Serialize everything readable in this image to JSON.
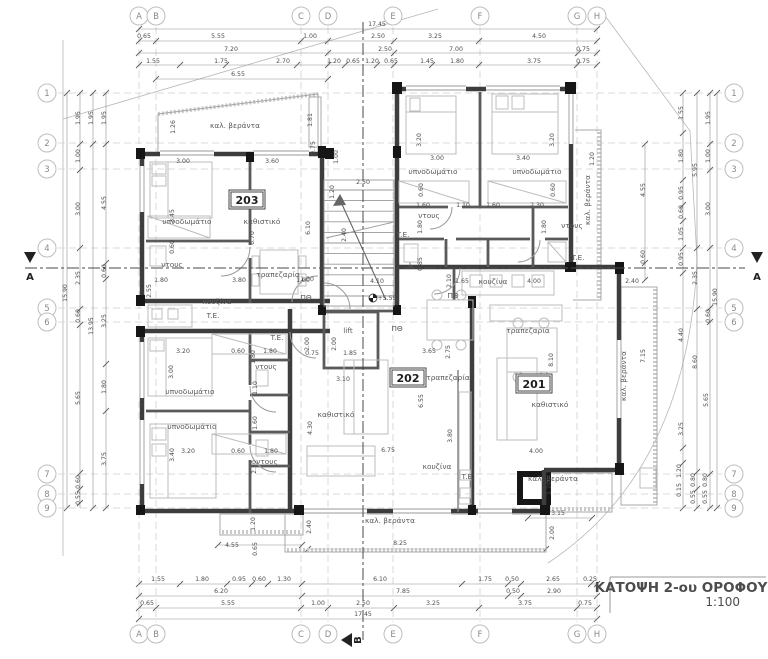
{
  "title": {
    "name": "ΚΑΤΟΨΗ 2-ου ΟΡΟΦΟΥ",
    "scale": "1:100"
  },
  "sections": {
    "a": "A",
    "b": "B"
  },
  "level_marker": "+5.55",
  "units": [
    {
      "n": "203",
      "x": 247,
      "y": 203
    },
    {
      "n": "202",
      "x": 408,
      "y": 381
    },
    {
      "n": "201",
      "x": 534,
      "y": 387
    }
  ],
  "grid": {
    "letters": [
      [
        "A",
        139
      ],
      [
        "B",
        156
      ],
      [
        "C",
        301
      ],
      [
        "D",
        328
      ],
      [
        "E",
        393
      ],
      [
        "F",
        480
      ],
      [
        "G",
        577
      ],
      [
        "H",
        597
      ]
    ],
    "numbers": [
      [
        "1",
        93
      ],
      [
        "2",
        143
      ],
      [
        "3",
        169
      ],
      [
        "4",
        248
      ],
      [
        "5",
        308
      ],
      [
        "6",
        322
      ],
      [
        "7",
        474
      ],
      [
        "8",
        494
      ],
      [
        "9",
        508
      ]
    ],
    "top_cy": 16,
    "bottom_cy": 634,
    "left_cx": 47,
    "right_cx": 734,
    "r": 9
  },
  "dim_lines": {
    "h": [
      {
        "y": 29,
        "x1": 139,
        "x2": 597,
        "ticks": [
          139,
          597
        ]
      },
      {
        "y": 41,
        "x1": 139,
        "x2": 597,
        "ticks": [
          139,
          156,
          301,
          328,
          394,
          479,
          597
        ]
      },
      {
        "y": 53,
        "x1": 139,
        "x2": 597,
        "ticks": [
          139,
          328,
          394,
          578,
          597
        ]
      },
      {
        "y": 65,
        "x1": 139,
        "x2": 597,
        "ticks": [
          139,
          180,
          226,
          297,
          328,
          345,
          377,
          394,
          432,
          479,
          577,
          597
        ]
      },
      {
        "y": 79,
        "x1": 156,
        "x2": 328,
        "ticks": [
          156,
          328
        ]
      },
      {
        "y": 584,
        "x1": 139,
        "x2": 597,
        "ticks": [
          139,
          180,
          227,
          252,
          268,
          302,
          462,
          508,
          521,
          591,
          597
        ]
      },
      {
        "y": 596,
        "x1": 139,
        "x2": 597,
        "ticks": [
          139,
          302,
          508,
          521,
          597
        ]
      },
      {
        "y": 608,
        "x1": 139,
        "x2": 597,
        "ticks": [
          139,
          156,
          301,
          328,
          394,
          479,
          577,
          597
        ]
      },
      {
        "y": 619,
        "x1": 139,
        "x2": 597,
        "ticks": [
          139,
          597
        ]
      },
      {
        "y": 545,
        "x1": 218,
        "x2": 302,
        "ticks": [
          218,
          302
        ]
      },
      {
        "y": 549,
        "x1": 308,
        "x2": 546,
        "ticks": [
          308,
          546
        ]
      },
      {
        "y": 518,
        "x1": 528,
        "x2": 592,
        "ticks": [
          528,
          592
        ]
      }
    ],
    "v": [
      {
        "x": 67,
        "y1": 93,
        "y2": 508,
        "ticks": [
          93,
          508
        ]
      },
      {
        "x": 80,
        "y1": 93,
        "y2": 508,
        "ticks": [
          93,
          144,
          170,
          248,
          309,
          325,
          473,
          489,
          503
        ]
      },
      {
        "x": 93,
        "y1": 93,
        "y2": 508,
        "ticks": [
          93,
          144,
          508
        ]
      },
      {
        "x": 106,
        "y1": 93,
        "y2": 508,
        "ticks": [
          93,
          144,
          263,
          279,
          364,
          411,
          508
        ]
      },
      {
        "x": 683,
        "y1": 93,
        "y2": 508,
        "ticks": [
          93,
          133,
          180,
          205,
          221,
          248,
          273,
          448,
          463,
          508
        ]
      },
      {
        "x": 697,
        "y1": 93,
        "y2": 508,
        "ticks": [
          93,
          248,
          309,
          472,
          489,
          508
        ]
      },
      {
        "x": 710,
        "y1": 93,
        "y2": 508,
        "ticks": [
          93,
          144,
          170,
          248,
          308,
          322,
          474,
          508
        ]
      },
      {
        "x": 717,
        "y1": 93,
        "y2": 508,
        "ticks": [
          93,
          508
        ]
      },
      {
        "x": 645,
        "y1": 144,
        "y2": 280,
        "ticks": [
          144,
          263,
          280
        ]
      }
    ]
  },
  "texts": {
    "dims": [
      [
        377,
        26,
        "17.45"
      ],
      [
        144,
        38,
        "0.65"
      ],
      [
        218,
        38,
        "5.55"
      ],
      [
        310,
        38,
        "1.00"
      ],
      [
        378,
        38,
        "2.50"
      ],
      [
        435,
        38,
        "3.25"
      ],
      [
        539,
        38,
        "4.50"
      ],
      [
        231,
        51,
        "7.20"
      ],
      [
        385,
        51,
        "2.50"
      ],
      [
        456,
        51,
        "7.00"
      ],
      [
        583,
        51,
        "0.75"
      ],
      [
        153,
        63,
        "1.55"
      ],
      [
        221,
        63,
        "1.75"
      ],
      [
        283,
        63,
        "2.70"
      ],
      [
        334,
        63,
        "1.20"
      ],
      [
        353,
        63,
        "0.65"
      ],
      [
        372,
        63,
        "1.20"
      ],
      [
        391,
        63,
        "0.65"
      ],
      [
        427,
        63,
        "1.45"
      ],
      [
        457,
        63,
        "1.80"
      ],
      [
        534,
        63,
        "3.75"
      ],
      [
        583,
        63,
        "0.75"
      ],
      [
        238,
        76,
        "6.55"
      ],
      [
        158,
        581,
        "1.55"
      ],
      [
        202,
        581,
        "1.80"
      ],
      [
        239,
        581,
        "0.95"
      ],
      [
        259,
        581,
        "0.60"
      ],
      [
        284,
        581,
        "1.30"
      ],
      [
        380,
        581,
        "6.10"
      ],
      [
        485,
        581,
        "1.75"
      ],
      [
        512,
        581,
        "0.50"
      ],
      [
        553,
        581,
        "2.65"
      ],
      [
        590,
        581,
        "0.25"
      ],
      [
        221,
        593,
        "6.20"
      ],
      [
        403,
        593,
        "7.85"
      ],
      [
        513,
        593,
        "0.50"
      ],
      [
        554,
        593,
        "2.90"
      ],
      [
        147,
        605,
        "0.65"
      ],
      [
        228,
        605,
        "5.55"
      ],
      [
        318,
        605,
        "1.00"
      ],
      [
        363,
        605,
        "2.50"
      ],
      [
        433,
        605,
        "3.25"
      ],
      [
        525,
        605,
        "3.75"
      ],
      [
        585,
        605,
        "0.75"
      ],
      [
        363,
        616,
        "17.45"
      ],
      [
        67,
        293,
        "15.90",
        1
      ],
      [
        80,
        118,
        "1.95",
        1
      ],
      [
        80,
        156,
        "1.00",
        1
      ],
      [
        80,
        209,
        "3.00",
        1
      ],
      [
        80,
        278,
        "2.35",
        1
      ],
      [
        80,
        316,
        "0.60",
        1
      ],
      [
        80,
        398,
        "5.65",
        1
      ],
      [
        80,
        482,
        "0.60",
        1
      ],
      [
        80,
        498,
        "0.55",
        1
      ],
      [
        93,
        118,
        "1.95",
        1
      ],
      [
        93,
        326,
        "13.95",
        1
      ],
      [
        106,
        118,
        "1.95",
        1
      ],
      [
        106,
        203,
        "4.55",
        1
      ],
      [
        106,
        271,
        "0.60",
        1
      ],
      [
        106,
        321,
        "3.25",
        1
      ],
      [
        106,
        387,
        "1.80",
        1
      ],
      [
        106,
        459,
        "3.75",
        1
      ],
      [
        683,
        113,
        "1.55",
        1
      ],
      [
        683,
        156,
        "1.80",
        1
      ],
      [
        683,
        193,
        "0.95",
        1
      ],
      [
        683,
        212,
        "0.60",
        1
      ],
      [
        683,
        234,
        "1.05",
        1
      ],
      [
        683,
        259,
        "0.95",
        1
      ],
      [
        683,
        335,
        "4.40",
        1
      ],
      [
        683,
        429,
        "3.25",
        1
      ],
      [
        681,
        471,
        "1.20",
        1
      ],
      [
        681,
        490,
        "0.15",
        1
      ],
      [
        697,
        170,
        "5.95",
        1
      ],
      [
        697,
        278,
        "2.35",
        1
      ],
      [
        697,
        362,
        "8.60",
        1
      ],
      [
        695,
        480,
        "0.80",
        1
      ],
      [
        695,
        497,
        "0.55",
        1
      ],
      [
        710,
        118,
        "1.95",
        1
      ],
      [
        710,
        156,
        "1.00",
        1
      ],
      [
        710,
        209,
        "3.00",
        1
      ],
      [
        710,
        316,
        "0.60",
        1
      ],
      [
        708,
        400,
        "5.65",
        1
      ],
      [
        707,
        480,
        "0.80",
        1
      ],
      [
        707,
        497,
        "0.55",
        1
      ],
      [
        717,
        297,
        "15.90",
        1
      ],
      [
        645,
        190,
        "4.55",
        1
      ],
      [
        645,
        257,
        "0.60",
        1
      ],
      [
        183,
        163,
        "3.00"
      ],
      [
        272,
        163,
        "3.60"
      ],
      [
        174,
        216,
        "3.45",
        1
      ],
      [
        254,
        238,
        "6.70",
        1
      ],
      [
        310,
        228,
        "6.10",
        1
      ],
      [
        174,
        247,
        "0.60",
        1
      ],
      [
        161,
        282,
        "1.80"
      ],
      [
        239,
        282,
        "3.80"
      ],
      [
        303,
        282,
        "1.00"
      ],
      [
        151,
        291,
        "2.55",
        1
      ],
      [
        175,
        127,
        "1.26",
        1
      ],
      [
        312,
        120,
        "1.81",
        1
      ],
      [
        315,
        148,
        "0.75",
        1
      ],
      [
        338,
        157,
        "1.00",
        1
      ],
      [
        363,
        184,
        "2.50"
      ],
      [
        334,
        192,
        "1.20",
        1
      ],
      [
        346,
        235,
        "2.40",
        1
      ],
      [
        307,
        281,
        "1.00"
      ],
      [
        377,
        283,
        "4.10"
      ],
      [
        387,
        300,
        "+5.55"
      ],
      [
        462,
        283,
        "1.65"
      ],
      [
        451,
        281,
        "2.10",
        1
      ],
      [
        422,
        264,
        "0.85",
        1
      ],
      [
        437,
        160,
        "3.00"
      ],
      [
        523,
        160,
        "3.40"
      ],
      [
        594,
        159,
        "1.20",
        1
      ],
      [
        421,
        140,
        "3.20",
        1
      ],
      [
        554,
        140,
        "3.20",
        1
      ],
      [
        423,
        190,
        "0.60",
        1
      ],
      [
        555,
        190,
        "0.60",
        1
      ],
      [
        423,
        207,
        "1.60"
      ],
      [
        463,
        207,
        "1.10"
      ],
      [
        493,
        207,
        "1.60"
      ],
      [
        537,
        207,
        "2.30"
      ],
      [
        422,
        227,
        "1.80",
        1
      ],
      [
        546,
        227,
        "1.80",
        1
      ],
      [
        632,
        283,
        "2.40"
      ],
      [
        534,
        283,
        "4.00"
      ],
      [
        183,
        353,
        "3.20"
      ],
      [
        238,
        353,
        "0.60"
      ],
      [
        270,
        353,
        "1.80"
      ],
      [
        173,
        372,
        "3.00",
        1
      ],
      [
        255,
        357,
        "1.80",
        1
      ],
      [
        257,
        388,
        "1.10",
        1
      ],
      [
        257,
        423,
        "1.60",
        1
      ],
      [
        188,
        453,
        "3.20"
      ],
      [
        238,
        453,
        "0.60"
      ],
      [
        271,
        453,
        "1.80"
      ],
      [
        174,
        455,
        "3.40",
        1
      ],
      [
        256,
        467,
        "2.30",
        1
      ],
      [
        312,
        428,
        "4.30",
        1
      ],
      [
        309,
        344,
        "2.00",
        1
      ],
      [
        336,
        344,
        "2.00",
        1
      ],
      [
        312,
        355,
        "0.75"
      ],
      [
        350,
        355,
        "1.85"
      ],
      [
        343,
        381,
        "3.10"
      ],
      [
        429,
        353,
        "3.65"
      ],
      [
        450,
        352,
        "2.75",
        1
      ],
      [
        423,
        401,
        "6.55",
        1
      ],
      [
        452,
        436,
        "3.80",
        1
      ],
      [
        388,
        452,
        "6.75"
      ],
      [
        536,
        453,
        "4.00"
      ],
      [
        553,
        360,
        "8.10",
        1
      ],
      [
        645,
        356,
        "7.15",
        1
      ],
      [
        232,
        547,
        "4.55"
      ],
      [
        257,
        549,
        "0.65",
        1
      ],
      [
        255,
        524,
        "1.20",
        1
      ],
      [
        311,
        527,
        "2.40",
        1
      ],
      [
        400,
        545,
        "8.25"
      ],
      [
        558,
        515,
        "3.15"
      ],
      [
        554,
        533,
        "2.00",
        1
      ],
      [
        551,
        488,
        "1.20",
        1
      ]
    ],
    "rooms": [
      [
        235,
        128,
        "καλ. βεράντα"
      ],
      [
        187,
        224,
        "υπνοδωμάτιο"
      ],
      [
        262,
        224,
        "καθιστικό"
      ],
      [
        278,
        277,
        "τραπεζαρία"
      ],
      [
        172,
        267,
        "ντους"
      ],
      [
        217,
        304,
        "κουζίνα"
      ],
      [
        213,
        318,
        "T.E."
      ],
      [
        277,
        340,
        "T.E."
      ],
      [
        190,
        394,
        "υπνοδωμάτιο"
      ],
      [
        192,
        429,
        "υπνοδωμάτιο"
      ],
      [
        266,
        369,
        "ντους"
      ],
      [
        267,
        464,
        "ντους"
      ],
      [
        433,
        174,
        "υπνοδωμάτιο"
      ],
      [
        537,
        174,
        "υπνοδωμάτιο"
      ],
      [
        429,
        218,
        "ντους"
      ],
      [
        572,
        228,
        "ντους"
      ],
      [
        403,
        237,
        "T.E."
      ],
      [
        578,
        260,
        "T.E."
      ],
      [
        493,
        284,
        "κουζίνα"
      ],
      [
        528,
        333,
        "τραπεζαρία"
      ],
      [
        550,
        407,
        "καθιστικό"
      ],
      [
        437,
        469,
        "κουζίνα"
      ],
      [
        468,
        479,
        "T.E."
      ],
      [
        448,
        380,
        "τραπεζαρία"
      ],
      [
        336,
        417,
        "καθιστικό"
      ],
      [
        348,
        333,
        "lift"
      ],
      [
        390,
        523,
        "καλ. βεράντα"
      ],
      [
        553,
        481,
        "καλ. βεράντα"
      ],
      [
        590,
        200,
        "καλ. βεράντα",
        1
      ],
      [
        626,
        376,
        "καλ. βεράντα",
        1
      ],
      [
        306,
        300,
        "ΠΘ"
      ],
      [
        453,
        298,
        "ΠΘ"
      ],
      [
        397,
        331,
        "ΠΘ"
      ],
      [
        411,
        268,
        "♿"
      ]
    ]
  }
}
